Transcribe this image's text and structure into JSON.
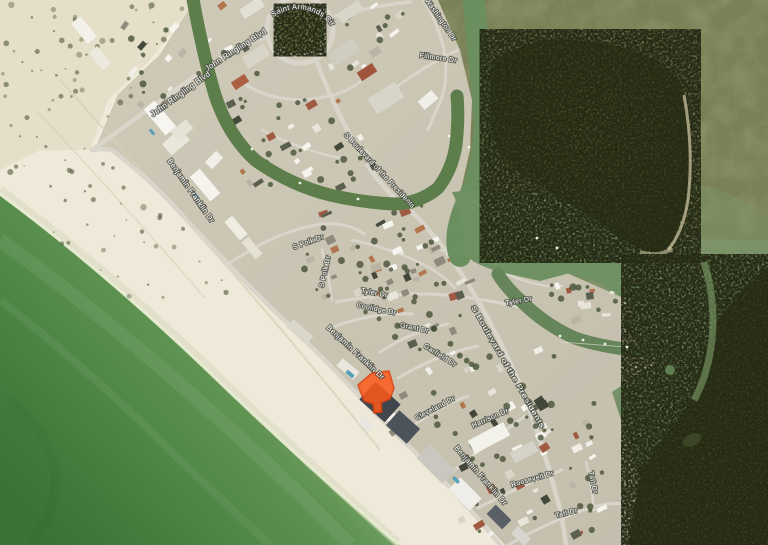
{
  "map": {
    "view": "satellite-imagery",
    "colors": {
      "gulf_shallow": "#c6dba8",
      "gulf_mid": "#5f9352",
      "gulf_deep": "#3a7336",
      "sand": "#eee9d8",
      "sand_dune": "#ddd5bf",
      "town": "#cbc5b4",
      "street": "#d9d5ca",
      "canal": "#5d7d4b",
      "channel": "#6b8f5e",
      "bay_flats": "#8b9168",
      "bay": "#74926a",
      "bay_deep": "#5f8757",
      "mangrove": "#454c2c",
      "mangrove_dark": "#343a20",
      "park": "#7b8452",
      "label_fill": "#ffffff",
      "label_halo": "#43473d"
    },
    "selected_parcel": {
      "fill": "#ff5a1a",
      "stroke": "#e03c0c",
      "opacity": 0.85
    },
    "street_labels": [
      {
        "text": "Saint Armands Cir",
        "curved": true,
        "size": 7.5
      },
      {
        "text": "John Ringling Blvd",
        "x": 237,
        "y": 52,
        "rot": -33,
        "size": 8
      },
      {
        "text": "John Ringling Blvd",
        "x": 182,
        "y": 96,
        "rot": -36,
        "size": 8
      },
      {
        "text": "S Washington Dr",
        "x": 437,
        "y": 18,
        "rot": 55,
        "size": 7
      },
      {
        "text": "Fillmore Dr",
        "x": 438,
        "y": 60,
        "rot": 8,
        "size": 7
      },
      {
        "text": "S Boulevard of the Presidents",
        "x": 378,
        "y": 172,
        "rot": 47,
        "size": 7,
        "stretch": 100
      },
      {
        "text": "S Boulevard of the Presidents",
        "x": 506,
        "y": 368,
        "rot": 60,
        "size": 7,
        "stretch": 140
      },
      {
        "text": "Benjamin Franklin Dr",
        "x": 189,
        "y": 192,
        "rot": 55,
        "size": 7.5
      },
      {
        "text": "Benjamin Franklin Dr",
        "x": 354,
        "y": 354,
        "rot": 43,
        "size": 7.5
      },
      {
        "text": "Benjamin Franklin Dr",
        "x": 479,
        "y": 477,
        "rot": 49,
        "size": 7.5
      },
      {
        "text": "S Polk Dr",
        "x": 309,
        "y": 244,
        "rot": -20,
        "size": 7
      },
      {
        "text": "S Polk Dr",
        "x": 327,
        "y": 272,
        "rot": -78,
        "size": 7
      },
      {
        "text": "Grant Dr",
        "x": 414,
        "y": 330,
        "rot": 12,
        "size": 7
      },
      {
        "text": "Garfield Dr",
        "x": 439,
        "y": 357,
        "rot": 32,
        "size": 7
      },
      {
        "text": "Cleveland Dr",
        "x": 436,
        "y": 410,
        "rot": -28,
        "size": 7
      },
      {
        "text": "Harrison Dr",
        "x": 491,
        "y": 420,
        "rot": -24,
        "size": 7
      },
      {
        "text": "Tyler Dr",
        "x": 374,
        "y": 295,
        "rot": 10,
        "size": 7
      },
      {
        "text": "Tyler Dr",
        "x": 519,
        "y": 303,
        "rot": -10,
        "size": 7
      },
      {
        "text": "Coolidge Dr",
        "x": 376,
        "y": 311,
        "rot": 12,
        "size": 7
      },
      {
        "text": "Roosevelt Dr",
        "x": 533,
        "y": 481,
        "rot": -16,
        "size": 7
      },
      {
        "text": "Taft Dr",
        "x": 567,
        "y": 515,
        "rot": -14,
        "size": 7
      },
      {
        "text": "Taft Dr",
        "x": 591,
        "y": 483,
        "rot": 78,
        "size": 7
      }
    ],
    "boats": [
      [
        537,
        238
      ],
      [
        557,
        248
      ],
      [
        449,
        136
      ],
      [
        469,
        147
      ],
      [
        560,
        336
      ],
      [
        583,
        340
      ],
      [
        605,
        344
      ],
      [
        627,
        347
      ],
      [
        300,
        183
      ],
      [
        358,
        199
      ],
      [
        252,
        149
      ]
    ]
  }
}
